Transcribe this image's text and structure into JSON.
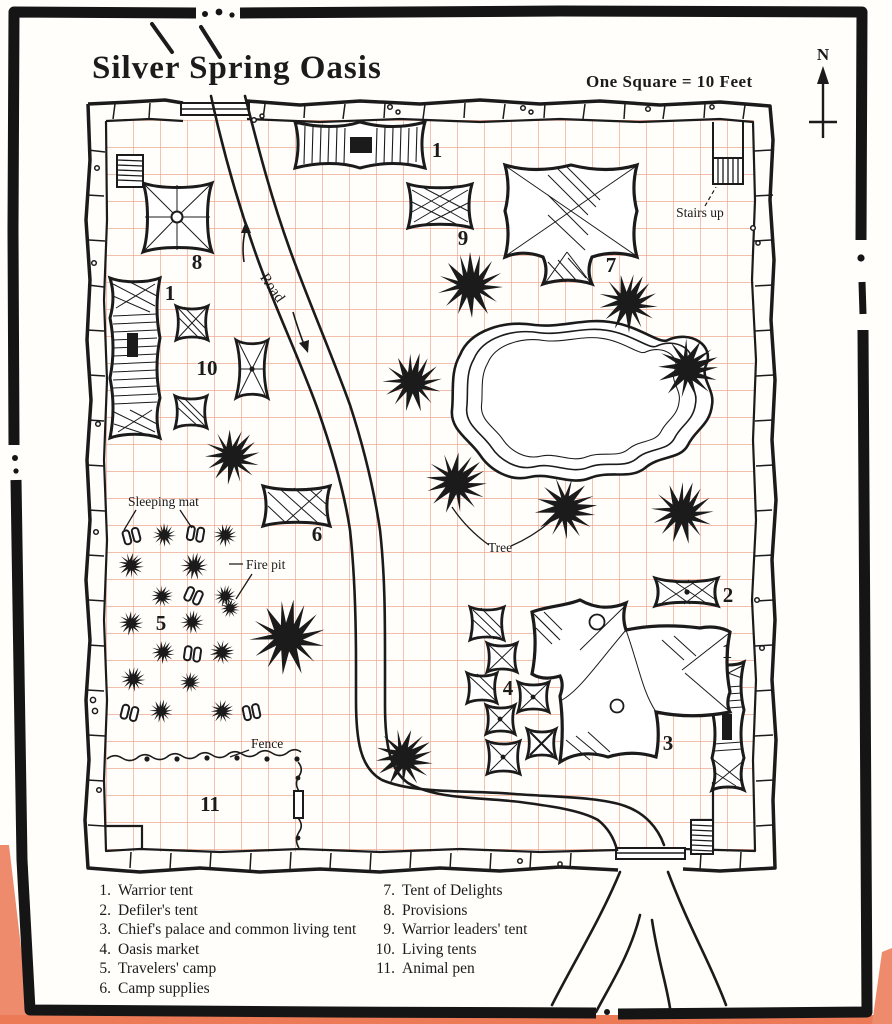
{
  "page": {
    "title": "Silver Spring Oasis",
    "scale_label": "One Square = 10 Feet",
    "compass_north": "N"
  },
  "map": {
    "feature_labels": {
      "stairs_up": "Stairs up",
      "road": "Road",
      "sleeping_mat": "Sleeping mat",
      "fire_pit": "Fire pit",
      "tree": "Tree",
      "fence": "Fence"
    },
    "markers": [
      {
        "label": "1",
        "feature": "warrior-tent-north"
      },
      {
        "label": "9",
        "feature": "warrior-leaders-tent"
      },
      {
        "label": "7",
        "feature": "tent-of-delights"
      },
      {
        "label": "8",
        "feature": "provisions"
      },
      {
        "label": "1",
        "feature": "warrior-tent-west"
      },
      {
        "label": "10",
        "feature": "living-tents"
      },
      {
        "label": "6",
        "feature": "camp-supplies"
      },
      {
        "label": "5",
        "feature": "travelers-camp"
      },
      {
        "label": "2",
        "feature": "defilers-tent"
      },
      {
        "label": "1",
        "feature": "warrior-tent-east"
      },
      {
        "label": "3",
        "feature": "chiefs-palace"
      },
      {
        "label": "4",
        "feature": "oasis-market"
      },
      {
        "label": "11",
        "feature": "animal-pen"
      }
    ]
  },
  "legend": {
    "items": [
      {
        "number": "1.",
        "label": "Warrior tent"
      },
      {
        "number": "2.",
        "label": "Defiler's tent"
      },
      {
        "number": "3.",
        "label": "Chief's palace and common living tent"
      },
      {
        "number": "4.",
        "label": "Oasis market"
      },
      {
        "number": "5.",
        "label": "Travelers' camp"
      },
      {
        "number": "6.",
        "label": "Camp supplies"
      },
      {
        "number": "7.",
        "label": "Tent of Delights"
      },
      {
        "number": "8.",
        "label": "Provisions"
      },
      {
        "number": "9.",
        "label": "Warrior leaders' tent"
      },
      {
        "number": "10.",
        "label": "Living tents"
      },
      {
        "number": "11.",
        "label": "Animal pen"
      }
    ]
  },
  "colors": {
    "ink": "#1b1b1b",
    "grid_line": "#f0a893",
    "paper": "#ffffff",
    "border_salmon": "#ef8b6d"
  }
}
